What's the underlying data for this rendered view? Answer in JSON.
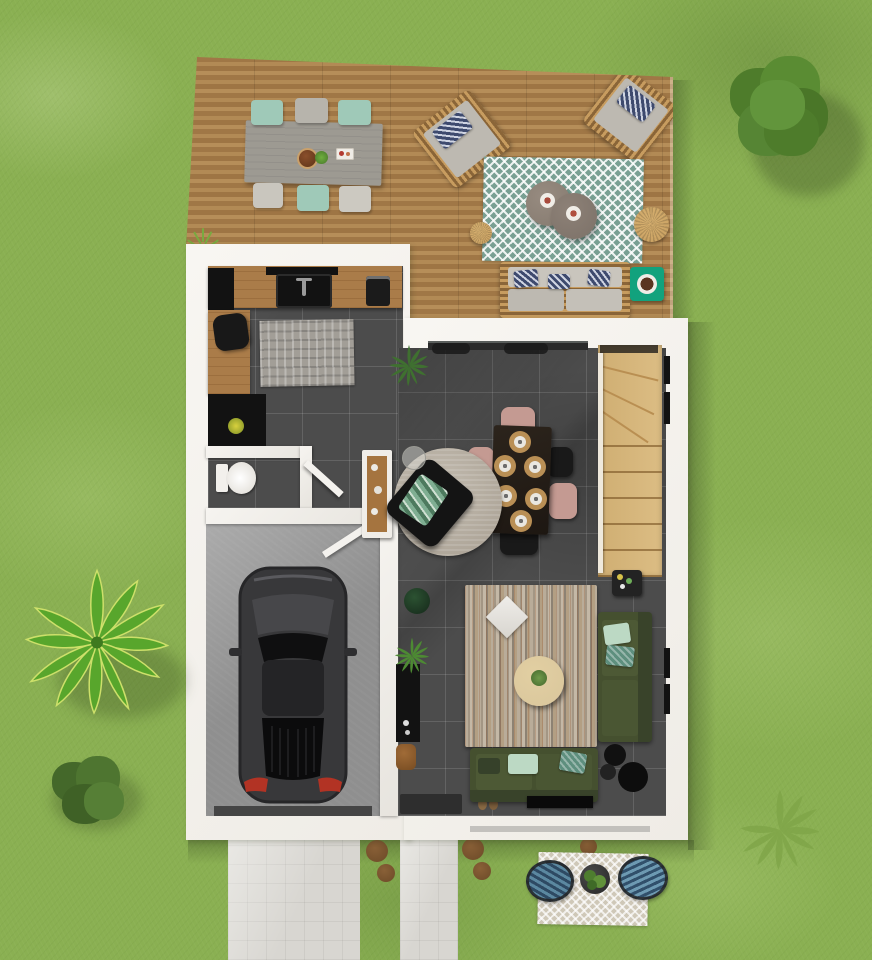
{
  "scene": {
    "kind": "3d-floor-plan-top-down-render",
    "subject": "ground floor of a house with garden, wooden terrace, garage and driveway",
    "visible_text": "none"
  },
  "palette": {
    "grass": "#8ab052",
    "pave": "#d8d6d1",
    "dirt": "#6b4526",
    "wood": "#b28a55",
    "wood-dk": "#a07746",
    "wall": "#efece6",
    "tile": "#4c4c4c",
    "garage": "#8f8f8f",
    "stair": "#dcbd84",
    "counter": "#aa7c49",
    "black": "#121212",
    "mint": "#bcd9c4",
    "navy": "#3e4a6e",
    "olive": "#45502f",
    "olive-dk": "#39432a",
    "pink": "#c49a92",
    "cream": "#d9c69c",
    "teal-table": "#12a27d",
    "rug-teal": "#79a093",
    "rug-round": "#a89f92",
    "mat": "#b98f55",
    "pouf": "#c89f60",
    "car": "#38383a",
    "taillight": "#b23324"
  },
  "rooms": [
    {
      "name": "terrace-deck",
      "floor": "wood planks",
      "items": [
        "outdoor dining table",
        "six dining chairs (mint and grey)",
        "two rattan lounge chairs with navy pillows",
        "teal chevron rug",
        "two round coffee tables",
        "two rattan poufs",
        "rattan outdoor sofa with navy pillows",
        "emerald side table with bowl",
        "grass tuft"
      ]
    },
    {
      "name": "kitchen",
      "floor": "dark grey tile",
      "items": [
        "wooden counter",
        "black sink",
        "cooktop",
        "coffee machine",
        "tall black cabinet",
        "desk chair",
        "grey patterned rug",
        "black refrigerator",
        "yellow potted plant",
        "palm plant"
      ]
    },
    {
      "name": "wc",
      "floor": "dark grey tile",
      "items": [
        "toilet",
        "open door"
      ]
    },
    {
      "name": "hallway",
      "floor": "dark grey tile",
      "items": [
        "white console with wood niche",
        "black wall cabinet",
        "two potted plants",
        "wooden stool",
        "dark doormat",
        "sandals",
        "open door to garage"
      ]
    },
    {
      "name": "garage",
      "floor": "concrete",
      "items": [
        "dark grey hatchback car"
      ]
    },
    {
      "name": "dining-area",
      "floor": "dark grey tile",
      "items": [
        "dark rectangular table",
        "six place settings",
        "three pink chairs",
        "three black chairs",
        "round beige rug",
        "black armchair with green throw",
        "glass floor lamp"
      ]
    },
    {
      "name": "living-room",
      "floor": "dark grey tile",
      "items": [
        "striped beige rug",
        "white diamond pillow",
        "round cream coffee table with plant",
        "olive corner sofa",
        "mint and teal cushions",
        "black floor lamp",
        "drinks side table",
        "tv unit",
        "sliding glass door with curtains",
        "window frames"
      ]
    },
    {
      "name": "staircase",
      "floor": "light wood",
      "items": [
        "winder staircase",
        "handrail",
        "window frames"
      ]
    }
  ],
  "garden": {
    "items": [
      "lawn",
      "large bush top-right",
      "banana plant left",
      "small bush bottom-left",
      "fern bottom-right",
      "wide driveway",
      "narrow walkway",
      "brown stepping circles",
      "patio bistro set with two blue chairs and planter"
    ]
  },
  "vehicle": {
    "type": "hatchback",
    "color": "dark grey",
    "location": "garage"
  }
}
